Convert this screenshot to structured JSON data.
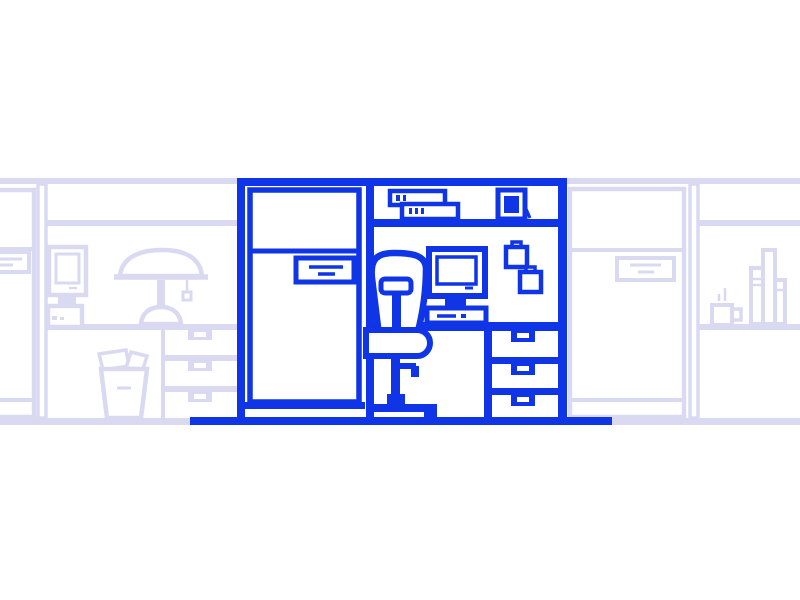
{
  "colors": {
    "primary": "#0f35e6",
    "faded": "#d9daf2",
    "white": "#ffffff"
  },
  "scene": {
    "kind": "flat line-art vector illustration",
    "subject": "Office cubicle workspace with refrigerator, desk computer, office chair and drawers, flanked by faded neighboring cubicles",
    "main_cubicle": {
      "objects": [
        "cubicle frame walls",
        "refrigerator with door label",
        "overhead shelf",
        "two stacked boxes on shelf",
        "framed picture on shelf",
        "desktop computer monitor with keyboard base",
        "two pinned notes on wall",
        "office swivel chair",
        "desk surface",
        "under-desk drawer unit with three drawers",
        "floor line"
      ]
    },
    "left_neighbor_cubicle": {
      "objects": [
        "partial refrigerator with label",
        "cubicle wall post",
        "overhead shelf line",
        "desktop computer",
        "desk lamp with pull chain",
        "desk surface",
        "drawer unit with three drawers",
        "trash can with papers"
      ]
    },
    "right_neighbor_cubicle": {
      "objects": [
        "refrigerator with door label",
        "cubicle wall post",
        "overhead shelf line",
        "wall shelf",
        "steaming coffee mug",
        "three books"
      ]
    }
  }
}
